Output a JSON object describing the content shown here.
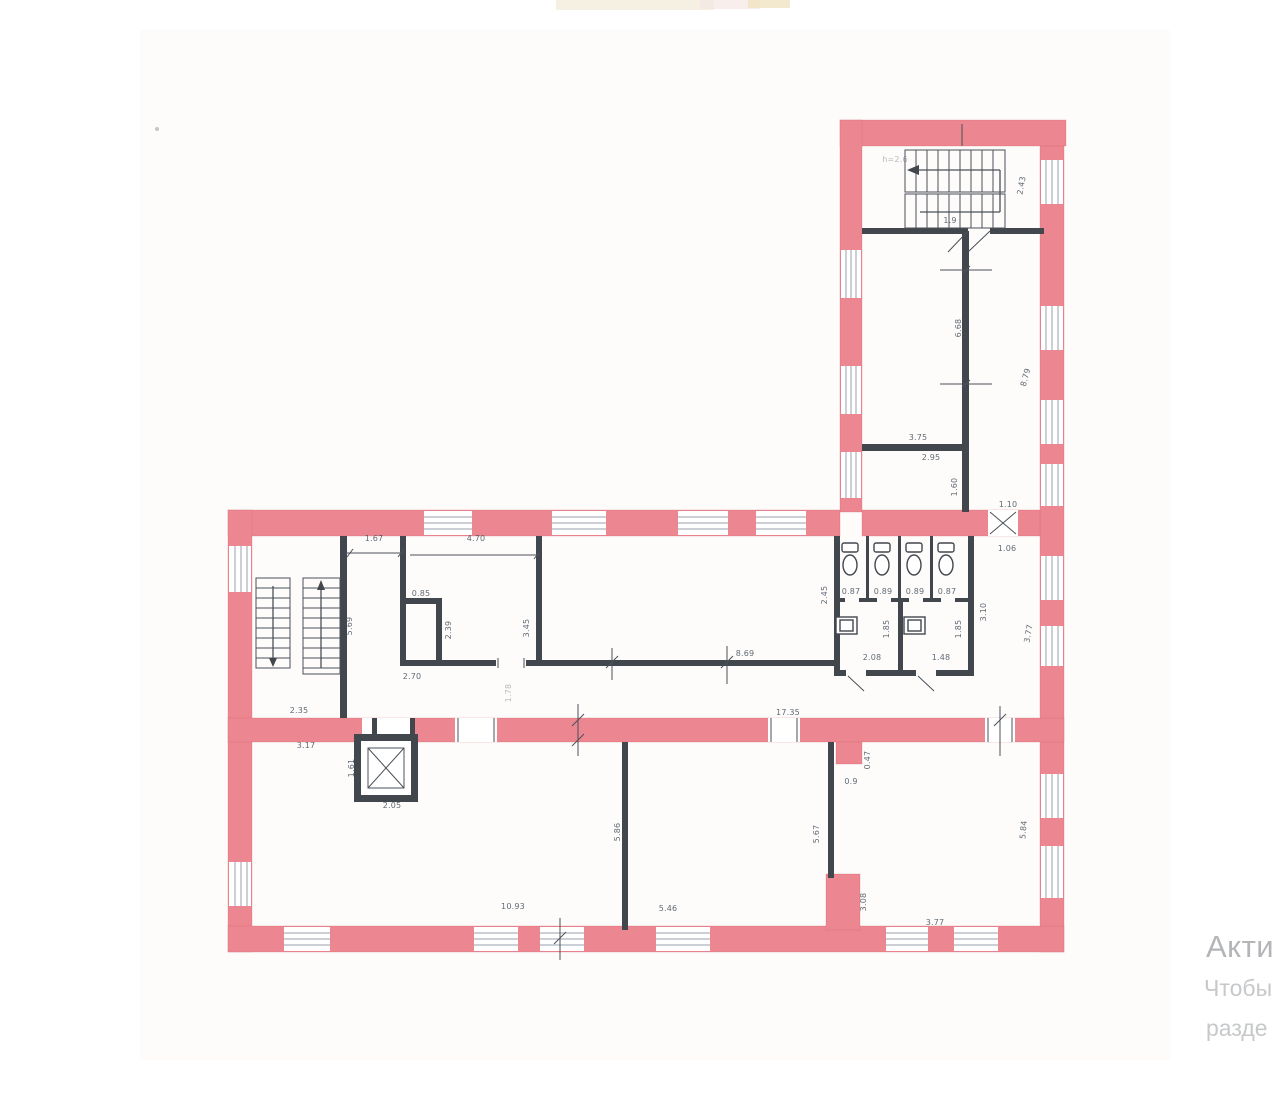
{
  "watermark": {
    "line1": "Акти",
    "line2": "Чтобы",
    "line3": "разде"
  },
  "colors": {
    "wall_pink": "#ec8690",
    "wall_pink_dark": "#d2636e",
    "wall_dark": "#42474e",
    "line": "#4b5159",
    "window_line": "#9aa2ac",
    "dim_text": "#3e4a59",
    "watermark_primary": "#b3b5b8",
    "watermark_secondary": "#c6c8ca",
    "paper_tint": "#f8f4ec"
  },
  "plan": {
    "dimension_labels": [
      {
        "t": "1.67",
        "x": 374,
        "y": 541
      },
      {
        "t": "4.70",
        "x": 476,
        "y": 541
      },
      {
        "t": "5.69",
        "x": 352,
        "y": 626,
        "r": -90
      },
      {
        "t": "0.85",
        "x": 421,
        "y": 596
      },
      {
        "t": "2.39",
        "x": 451,
        "y": 630,
        "r": -90
      },
      {
        "t": "2.70",
        "x": 412,
        "y": 679
      },
      {
        "t": "3.45",
        "x": 529,
        "y": 628,
        "r": -90
      },
      {
        "t": "1.78",
        "x": 511,
        "y": 693,
        "r": -90,
        "f": 1
      },
      {
        "t": "8.69",
        "x": 745,
        "y": 656
      },
      {
        "t": "2.45",
        "x": 827,
        "y": 595,
        "r": -90
      },
      {
        "t": "0.87",
        "x": 851,
        "y": 594
      },
      {
        "t": "0.89",
        "x": 883,
        "y": 594
      },
      {
        "t": "0.89",
        "x": 915,
        "y": 594
      },
      {
        "t": "0.87",
        "x": 947,
        "y": 594
      },
      {
        "t": "1.85",
        "x": 889,
        "y": 629,
        "r": -90
      },
      {
        "t": "1.85",
        "x": 961,
        "y": 629,
        "r": -90
      },
      {
        "t": "2.08",
        "x": 872,
        "y": 660
      },
      {
        "t": "1.48",
        "x": 941,
        "y": 660
      },
      {
        "t": "3.10",
        "x": 986,
        "y": 612,
        "r": -90
      },
      {
        "t": "3.77",
        "x": 1031,
        "y": 634,
        "r": -80
      },
      {
        "t": "1.60",
        "x": 957,
        "y": 487,
        "r": -90
      },
      {
        "t": "1.10",
        "x": 1008,
        "y": 507
      },
      {
        "t": "1.06",
        "x": 1007,
        "y": 551
      },
      {
        "t": "3.75",
        "x": 918,
        "y": 440
      },
      {
        "t": "2.95",
        "x": 931,
        "y": 460
      },
      {
        "t": "6.68",
        "x": 961,
        "y": 328,
        "r": -90
      },
      {
        "t": "8.79",
        "x": 1028,
        "y": 378,
        "r": -75
      },
      {
        "t": "2.43",
        "x": 1024,
        "y": 186,
        "r": -80
      },
      {
        "t": "1.9",
        "x": 950,
        "y": 223
      },
      {
        "t": "h=2.6",
        "x": 895,
        "y": 162,
        "f": 1
      },
      {
        "t": "2.35",
        "x": 299,
        "y": 713
      },
      {
        "t": "3.17",
        "x": 306,
        "y": 748
      },
      {
        "t": "17.35",
        "x": 788,
        "y": 715
      },
      {
        "t": "1.61",
        "x": 354,
        "y": 768,
        "r": -90
      },
      {
        "t": "2.05",
        "x": 392,
        "y": 808
      },
      {
        "t": "10.93",
        "x": 513,
        "y": 909
      },
      {
        "t": "5.46",
        "x": 668,
        "y": 911
      },
      {
        "t": "5.86",
        "x": 620,
        "y": 832,
        "r": -90
      },
      {
        "t": "5.67",
        "x": 819,
        "y": 834,
        "r": -90
      },
      {
        "t": "0.47",
        "x": 870,
        "y": 760,
        "r": -90
      },
      {
        "t": "0.9",
        "x": 851,
        "y": 784
      },
      {
        "t": "5.84",
        "x": 1026,
        "y": 830,
        "r": -85
      },
      {
        "t": "3.08",
        "x": 866,
        "y": 902,
        "r": -90
      },
      {
        "t": "3.77",
        "x": 935,
        "y": 925
      }
    ]
  }
}
